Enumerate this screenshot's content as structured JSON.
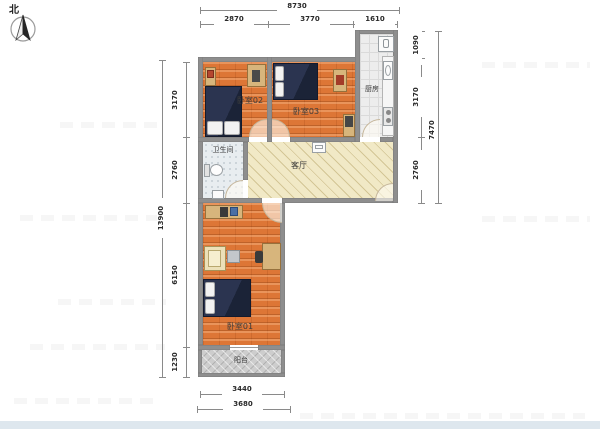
{
  "compass": {
    "north_label": "北"
  },
  "dimensions": {
    "top": {
      "total": "8730",
      "segments": [
        "2870",
        "3770",
        "1610"
      ]
    },
    "left": {
      "total": "13900",
      "segments": [
        "3170",
        "2760",
        "6150",
        "1230"
      ]
    },
    "right": {
      "total": "7470",
      "segments": [
        "1090",
        "3170",
        "2760"
      ]
    },
    "bottom": {
      "segments": [
        "3440",
        "3680"
      ]
    }
  },
  "rooms": {
    "bedroom2": {
      "label": "卧室02"
    },
    "bedroom3": {
      "label": "卧室03"
    },
    "bedroom1": {
      "label": "卧室01"
    },
    "kitchen": {
      "label": "厨房"
    },
    "bathroom": {
      "label": "卫生间"
    },
    "living_room": {
      "label": "客厅"
    },
    "balcony": {
      "label": "阳台"
    }
  },
  "colors": {
    "wall": "#8e8e8e",
    "bedroom_floor": "#dd7636",
    "living_floor": "#f1e9c6",
    "bathroom_floor": "#e8edf0",
    "kitchen_floor": "#ededed",
    "balcony_floor": "#cdcdcd",
    "bed": "#2b3450",
    "furniture_wood": "#d7b57c",
    "footer_band": "#dee7ee"
  }
}
